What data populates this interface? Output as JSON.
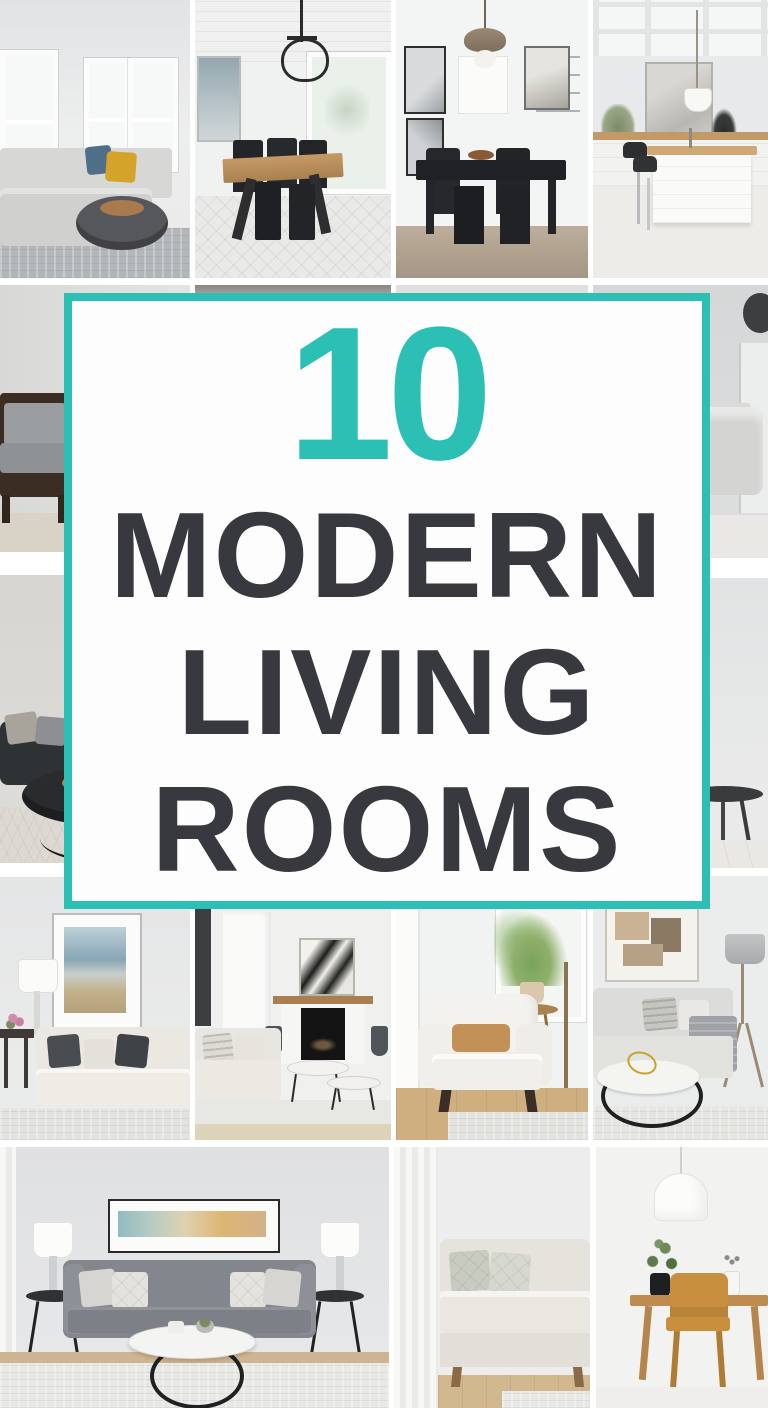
{
  "overlay": {
    "number": "10",
    "lines": [
      "MODERN",
      "LIVING",
      "ROOMS"
    ],
    "accent_color": "#2cc0b4",
    "title_color": "#38383f",
    "card_background": "#fdfdfd"
  },
  "grid": {
    "gap_color": "#ffffff",
    "tiles": [
      {
        "id": "living-room-sectional",
        "desc": "Living room with gray sectional sofa, blue and mustard pillows, round dark coffee table and windows"
      },
      {
        "id": "dining-room-farmhouse",
        "desc": "Dining room with wood trestle table, black chairs, iron chandelier, shiplap ceiling and patterned rug"
      },
      {
        "id": "dining-nook-black-table",
        "desc": "Dining nook with black table and chairs, brass pendant light and gallery frames"
      },
      {
        "id": "kitchen-island",
        "desc": "White kitchen with island, wood counters, black bar stools, framed art and coffered ceiling"
      },
      {
        "id": "armchair-corner",
        "desc": "Corner with dark wood armchair and gray cushions"
      },
      {
        "id": "hidden-photo-left",
        "desc": "Photo mostly hidden behind the title card"
      },
      {
        "id": "hidden-photo-right",
        "desc": "Photo mostly hidden behind the title card"
      },
      {
        "id": "sofa-with-art",
        "desc": "Light gray sofa below framed art with dark wall ornament"
      },
      {
        "id": "dark-sofa-lounge",
        "desc": "Charcoal sofa with gray pillows, round dark coffee table and arc floor lamp"
      },
      {
        "id": "plant-on-sideboard",
        "desc": "Leafy plant in dark vase on a dark wood sideboard with round side table"
      },
      {
        "id": "cream-sofa-seascape",
        "desc": "Cream sofa with charcoal pillows under framed seascape art beside a white lamp and flowers"
      },
      {
        "id": "fireplace-living-room",
        "desc": "Living room with fireplace, wood mantel, black and white abstract art, light sofa and nesting tables"
      },
      {
        "id": "white-armchair",
        "desc": "White armchair with tan lumbar pillow beside a potted plant in a bright window"
      },
      {
        "id": "sofa-with-throw",
        "desc": "Light sofa with striped pillows and gray throw, round marble coffee table with gold decor and tripod lamp"
      },
      {
        "id": "gray-sofa-symmetric",
        "desc": "Gray sofa flanked by white lamps on black side tables under panoramic art with round white coffee table"
      },
      {
        "id": "beige-sofa-curtain",
        "desc": "Beige sofa with patterned pillows beside a sheer curtain"
      },
      {
        "id": "wood-desk-chair",
        "desc": "Wooden desk with mustard chair, white pendant lamp and plants"
      }
    ]
  }
}
